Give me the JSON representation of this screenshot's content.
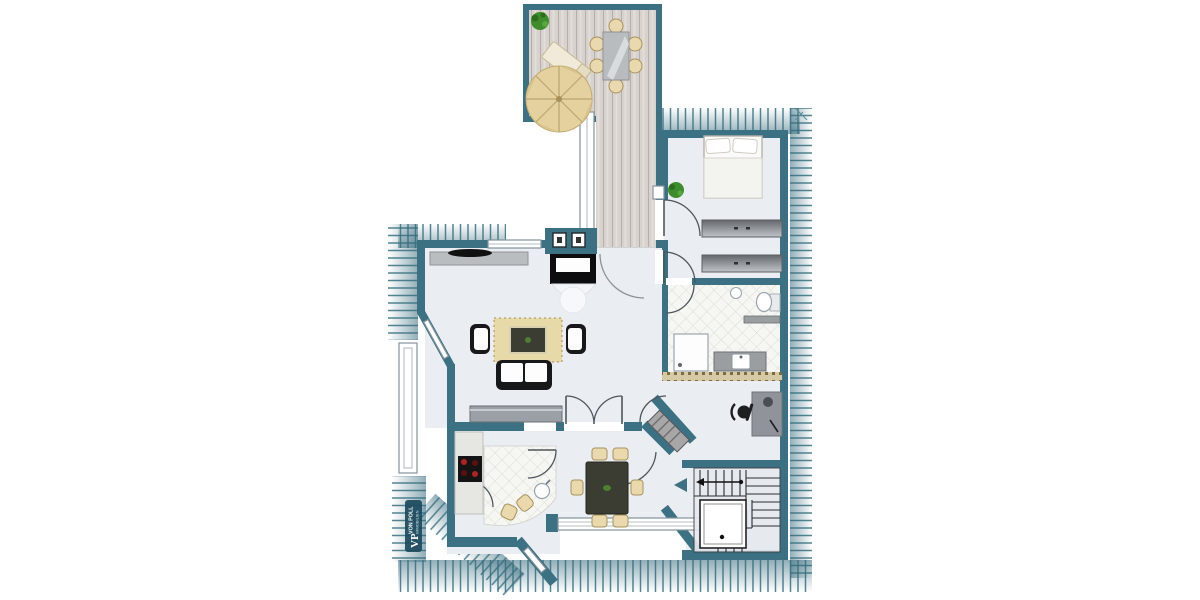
{
  "document": {
    "type": "floor-plan",
    "title": "attic floor plan",
    "watermark": {
      "monogram": "VP",
      "name": "VON POLL",
      "subtitle": "IMMOBILIEN"
    }
  },
  "colors": {
    "wall": "#3c7183",
    "floor": "#eaedf2",
    "hatch_line": "#35707f",
    "deck": "#d8d2ce",
    "deck_line": "#b6aeab",
    "tile": "#f6f6f3",
    "tile_line": "#dcdcd6",
    "rug": "#e8d9a9",
    "beige": "#ead9ad",
    "beige_border": "#a8925c",
    "furn_gray": "#9b9ea1",
    "furn_dark": "#17181a",
    "table_dark": "#3b3d33",
    "plant": "#3e8d2c",
    "burner_red": "#b32222",
    "knee_wall": "#d6c9a6",
    "watermark_bg": "#1c4a5e"
  },
  "rooms": [
    {
      "name": "terrace",
      "furniture": [
        "parasol",
        "sun-lounger",
        "outdoor-table",
        "six-chairs",
        "potted-plant"
      ]
    },
    {
      "name": "deck-walkway",
      "furniture": []
    },
    {
      "name": "living-room",
      "furniture": [
        "chimney-stove",
        "sideboard",
        "rug",
        "coffee-table",
        "two-armchairs",
        "sofa",
        "lowboard"
      ]
    },
    {
      "name": "kitchen",
      "furniture": [
        "counter",
        "cooktop",
        "round-sink",
        "two-stools"
      ]
    },
    {
      "name": "dining-area",
      "furniture": [
        "dining-table",
        "six-chairs"
      ]
    },
    {
      "name": "bedroom",
      "furniture": [
        "double-bed",
        "two-wardrobes",
        "potted-plant"
      ]
    },
    {
      "name": "bathroom",
      "furniture": [
        "shower",
        "vanity-sink",
        "toilet",
        "radiator"
      ]
    },
    {
      "name": "study-hall",
      "furniture": [
        "desk",
        "swivel-chair",
        "dresser"
      ]
    },
    {
      "name": "staircase",
      "furniture": [
        "u-shaped-stairs"
      ]
    }
  ]
}
